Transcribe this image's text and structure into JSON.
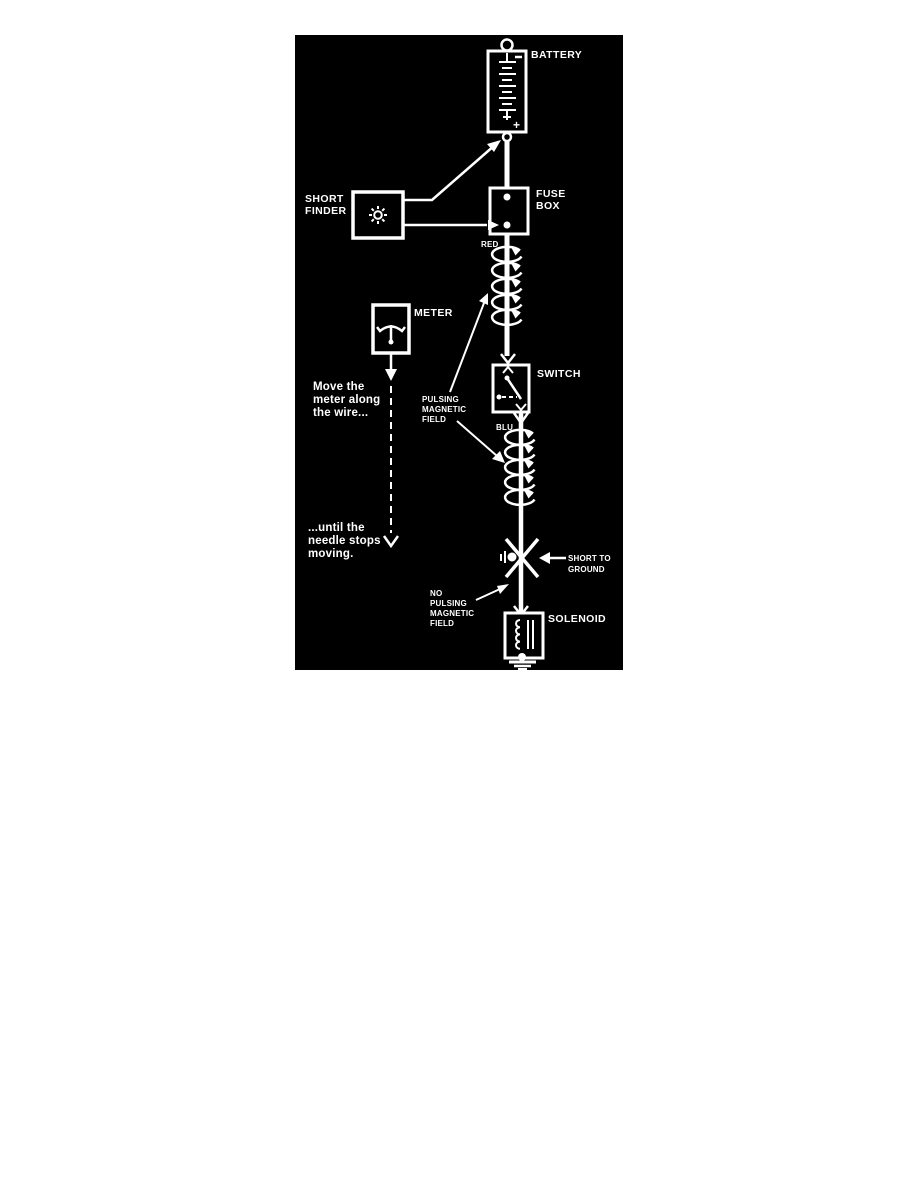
{
  "colors": {
    "page_bg": "#ffffff",
    "panel_bg": "#000000",
    "ink": "#ffffff"
  },
  "components": {
    "battery": {
      "label": "BATTERY",
      "positive_terminal": "+"
    },
    "fuse_box": {
      "label": [
        "FUSE",
        "BOX"
      ]
    },
    "short_finder": {
      "label": [
        "SHORT",
        "FINDER"
      ],
      "icon": "sunburst-icon"
    },
    "meter": {
      "label": "METER",
      "icon": "gauge-needle-icon"
    },
    "switch": {
      "label": "SWITCH"
    },
    "solenoid": {
      "label": "SOLENOID",
      "icon": "coil-and-core-icon"
    }
  },
  "wires": {
    "red_label": "RED",
    "blue_label": "BLU"
  },
  "annotations": {
    "pulsing_field": [
      "PULSING",
      "MAGNETIC",
      "FIELD"
    ],
    "no_pulsing_field": [
      "NO",
      "PULSING",
      "MAGNETIC",
      "FIELD"
    ],
    "short_to_ground": [
      "SHORT TO",
      "GROUND"
    ],
    "instruction_move": [
      "Move the",
      "meter along",
      "the wire..."
    ],
    "instruction_until": [
      "...until the",
      "needle stops",
      "moving."
    ]
  }
}
